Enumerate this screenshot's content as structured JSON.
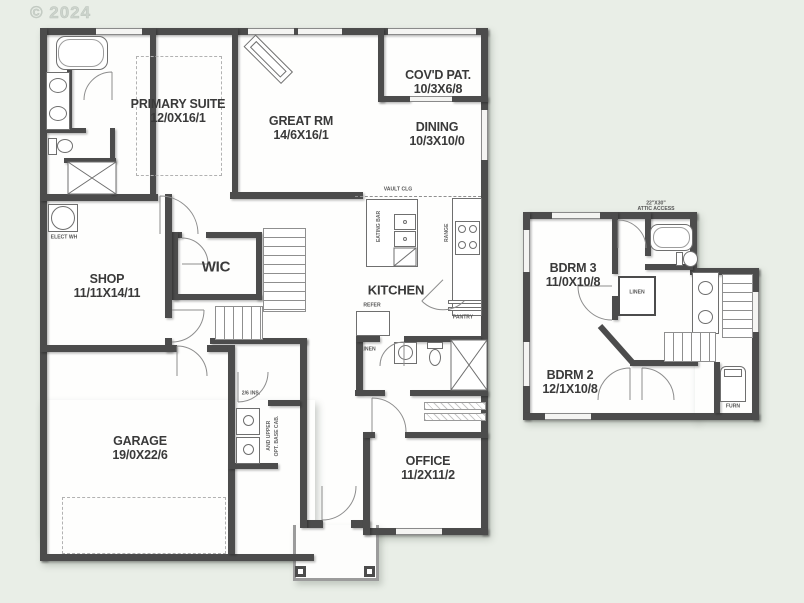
{
  "watermark": "© 2024",
  "main_floor": {
    "primary_suite": {
      "name": "PRIMARY SUITE",
      "dims": "12/0X16/1"
    },
    "great_rm": {
      "name": "GREAT RM",
      "dims": "14/6X16/1"
    },
    "covd_pat": {
      "name": "COV'D PAT.",
      "dims": "10/3X6/8"
    },
    "dining": {
      "name": "DINING",
      "dims": "10/3X10/0"
    },
    "shop": {
      "name": "SHOP",
      "dims": "11/11X14/11"
    },
    "wic": {
      "name": "WIC"
    },
    "kitchen": {
      "name": "KITCHEN"
    },
    "garage": {
      "name": "GARAGE",
      "dims": "19/0X22/6"
    },
    "office": {
      "name": "OFFICE",
      "dims": "11/2X11/2"
    },
    "notes": {
      "vault_clg": "VAULT CLG",
      "refer": "REFER",
      "pantry": "PANTRY",
      "linen": "LINEN",
      "range": "RANGE",
      "eating_bar": "EATING BAR",
      "water_heater": "ELECT WH",
      "cab_upper": "AND UPPER",
      "cab_base": "OPT. BASE CAB.",
      "door_size": "2/6 INS."
    }
  },
  "upper_floor": {
    "bdrm3": {
      "name": "BDRM 3",
      "dims": "11/0X10/8"
    },
    "bdrm2": {
      "name": "BDRM 2",
      "dims": "12/1X10/8"
    },
    "notes": {
      "attic_line1": "22\"X30\"",
      "attic_line2": "ATTIC ACCESS",
      "linen": "LINEN",
      "furn": "FURN"
    }
  },
  "colors": {
    "background": "#e9eee7",
    "paper": "#fefefd",
    "wall": "#4c4c4c",
    "text": "#3a3a3a"
  }
}
